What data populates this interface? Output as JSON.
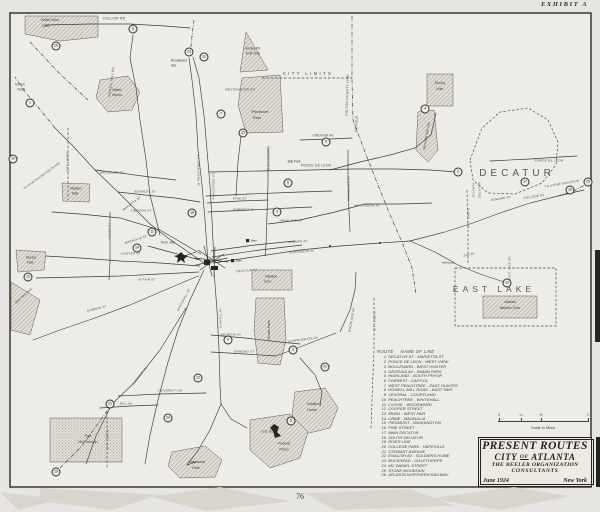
{
  "page": {
    "exhibit_label": "EXHIBIT A",
    "page_number": "76"
  },
  "title_box": {
    "line1": "PRESENT ROUTES",
    "city_pre": "CITY",
    "city_of": "OF",
    "city_post": "ATLANTA",
    "org_line1": "THE BEELER ORGANIZATION",
    "org_line2": "CONSULTANTS",
    "date": "June 1924",
    "place": "New York"
  },
  "scale_bar": {
    "ticks": [
      "0",
      "¼",
      "½",
      "1"
    ],
    "caption": "Scale in Miles"
  },
  "route_list": {
    "col_route": "ROUTE",
    "col_name": "NAME OF LINE",
    "routes": [
      {
        "num": "1",
        "name": "DECATUR ST - MARIETTA ST"
      },
      {
        "num": "2",
        "name": "PONCE DE LEON - WEST VIEW"
      },
      {
        "num": "3",
        "name": "BOULEVARD - WEST HUNTER"
      },
      {
        "num": "4",
        "name": "GEORGIA AV - INMAN PARK"
      },
      {
        "num": "5",
        "name": "HIGHLAND - SOUTH PRYOR"
      },
      {
        "num": "6",
        "name": "FORREST - CAPITOL"
      },
      {
        "num": "7",
        "name": "WEST PEACHTREE - EAST HUNTER"
      },
      {
        "num": "8",
        "name": "HOWELL MILL ROAD - EAST FAIR"
      },
      {
        "num": "9",
        "name": "CENTRAL - COURTLAND"
      },
      {
        "num": "10",
        "name": "PEACHTREE - WHITEHALL"
      },
      {
        "num": "11",
        "name": "LUCKIE - WOODWARD"
      },
      {
        "num": "12",
        "name": "COOPER STREET"
      },
      {
        "num": "13",
        "name": "IRWIN - WEST FAIR"
      },
      {
        "num": "14",
        "name": "ORME - MAGNOLIA"
      },
      {
        "num": "15",
        "name": "PIEDMONT - WASHINGTON"
      },
      {
        "num": "16",
        "name": "PINE STREET"
      },
      {
        "num": "17",
        "name": "MAIN DECATUR"
      },
      {
        "num": "18",
        "name": "SOUTH DECATUR"
      },
      {
        "num": "19",
        "name": "RIVER LINE"
      },
      {
        "num": "20",
        "name": "COLLEGE PARK - HAPEVILLE"
      },
      {
        "num": "21",
        "name": "STEWART AVENUE"
      },
      {
        "num": "22",
        "name": "ENGLISH AV - SOLDIERS HOME"
      },
      {
        "num": "23",
        "name": "BUCKHEAD - OGLETHORPE"
      },
      {
        "num": "24",
        "name": "MC DANIEL STREET"
      },
      {
        "num": "25",
        "name": "STONE MOUNTAIN"
      },
      {
        "num": "26",
        "name": "ATLANTA NORTHERN RAILWAY"
      }
    ]
  },
  "map": {
    "ink_color": "#3b3a33",
    "paper_color": "#edece6",
    "labels": [
      {
        "t": "North View",
        "x": 50,
        "y": 21,
        "r": 0,
        "s": 3.6,
        "cls": "p"
      },
      {
        "t": "Cem.",
        "x": 46,
        "y": 27,
        "r": 0,
        "s": 3.6,
        "cls": "p"
      },
      {
        "t": "COLLIER RD",
        "x": 114,
        "y": 19,
        "r": 0,
        "s": 3.4,
        "cls": "s"
      },
      {
        "t": "HOWELL MILL RD",
        "x": 112,
        "y": 82,
        "r": -82,
        "s": 3.2,
        "cls": "s"
      },
      {
        "t": "Inman",
        "x": 20,
        "y": 85,
        "r": 0,
        "s": 3.4,
        "cls": "p"
      },
      {
        "t": "Yards",
        "x": 21,
        "y": 90,
        "r": 0,
        "s": 3.4,
        "cls": "p"
      },
      {
        "t": "Water",
        "x": 117,
        "y": 91,
        "r": 0,
        "s": 3.6,
        "cls": "p"
      },
      {
        "t": "Works",
        "x": 117,
        "y": 96,
        "r": 0,
        "s": 3.6,
        "cls": "p"
      },
      {
        "t": "Brookwood",
        "x": 179,
        "y": 61,
        "r": 0,
        "s": 3.2,
        "cls": "p"
      },
      {
        "t": "Sta.",
        "x": 174,
        "y": 66,
        "r": 0,
        "s": 3.2,
        "cls": "p"
      },
      {
        "t": "Ansley Pk.",
        "x": 253,
        "y": 49,
        "r": 0,
        "s": 3.4,
        "cls": "p"
      },
      {
        "t": "Golf Club",
        "x": 253,
        "y": 54,
        "r": 0,
        "s": 3.4,
        "cls": "p"
      },
      {
        "t": "CITY LIMITS",
        "x": 308,
        "y": 74,
        "r": 0,
        "s": 4.2,
        "cls": "s sls"
      },
      {
        "t": "FULTON COUNTY LINE",
        "x": 348,
        "y": 95,
        "r": -88,
        "s": 3.4,
        "cls": "s"
      },
      {
        "t": "DE KALB",
        "x": 357,
        "y": 124,
        "r": -88,
        "s": 3.4,
        "cls": "s"
      },
      {
        "t": "Emory",
        "x": 440,
        "y": 84,
        "r": 0,
        "s": 3.6,
        "cls": "p"
      },
      {
        "t": "Univ.",
        "x": 440,
        "y": 90,
        "r": 0,
        "s": 3.6,
        "cls": "p"
      },
      {
        "t": "Druid Hills Golf Club",
        "x": 427,
        "y": 136,
        "r": -80,
        "s": 3.1,
        "cls": "p"
      },
      {
        "t": "DECATUR",
        "x": 517,
        "y": 174,
        "r": 0,
        "s": 10,
        "cls": "big"
      },
      {
        "t": "PONCE DE LEON",
        "x": 549,
        "y": 161,
        "r": 0,
        "s": 3.1,
        "cls": "s"
      },
      {
        "t": "TO STONE MOUNTAIN",
        "x": 562,
        "y": 184,
        "r": -10,
        "s": 2.9,
        "cls": "s"
      },
      {
        "t": "ATLANTA",
        "x": 474,
        "y": 190,
        "r": -90,
        "s": 3,
        "cls": "s"
      },
      {
        "t": "DECATUR",
        "x": 480,
        "y": 190,
        "r": -90,
        "s": 3,
        "cls": "s"
      },
      {
        "t": "HOWARD ST",
        "x": 501,
        "y": 199,
        "r": -9,
        "s": 3,
        "cls": "s"
      },
      {
        "t": "COLLEGE AV",
        "x": 534,
        "y": 197,
        "r": -9,
        "s": 3,
        "cls": "s"
      },
      {
        "t": "PONCE DE LEON",
        "x": 316,
        "y": 166,
        "r": 0,
        "s": 3.3,
        "cls": "s"
      },
      {
        "t": "Ball Park",
        "x": 294,
        "y": 162,
        "r": 0,
        "s": 3.2,
        "cls": "p"
      },
      {
        "t": "VIRGINIA AV",
        "x": 323,
        "y": 136,
        "r": 0,
        "s": 3.2,
        "cls": "s"
      },
      {
        "t": "WESTMINSTER DR",
        "x": 240,
        "y": 90,
        "r": 0,
        "s": 2.9,
        "cls": "s"
      },
      {
        "t": "Piedmont",
        "x": 260,
        "y": 112,
        "r": 0,
        "s": 4,
        "cls": "p"
      },
      {
        "t": "Park",
        "x": 257,
        "y": 118,
        "r": 0,
        "s": 4,
        "cls": "p"
      },
      {
        "t": "W PEACHTREE ST",
        "x": 199,
        "y": 170,
        "r": -90,
        "s": 3.1,
        "cls": "s"
      },
      {
        "t": "PEACHTREE ST",
        "x": 214,
        "y": 186,
        "r": -90,
        "s": 3.1,
        "cls": "s"
      },
      {
        "t": "N BOULEVARD",
        "x": 269,
        "y": 158,
        "r": -90,
        "s": 3.1,
        "cls": "s"
      },
      {
        "t": "MORELAND AV",
        "x": 349,
        "y": 188,
        "r": -90,
        "s": 3.1,
        "cls": "s"
      },
      {
        "t": "PINE ST",
        "x": 240,
        "y": 199,
        "r": 0,
        "s": 3,
        "cls": "s"
      },
      {
        "t": "FORREST AV",
        "x": 244,
        "y": 210,
        "r": 0,
        "s": 3,
        "cls": "s"
      },
      {
        "t": "HIGHLAND AV",
        "x": 291,
        "y": 221,
        "r": 0,
        "s": 3,
        "cls": "s"
      },
      {
        "t": "MC LENDON AV",
        "x": 367,
        "y": 206,
        "r": 0,
        "s": 3,
        "cls": "s"
      },
      {
        "t": "BELLWOOD AV",
        "x": 112,
        "y": 173,
        "r": 0,
        "s": 3,
        "cls": "s"
      },
      {
        "t": "KENNEDY ST",
        "x": 145,
        "y": 192,
        "r": 0,
        "s": 3,
        "cls": "s"
      },
      {
        "t": "SIMPSON ST",
        "x": 141,
        "y": 211,
        "r": 0,
        "s": 3,
        "cls": "s"
      },
      {
        "t": "HUNTER ST",
        "x": 131,
        "y": 254,
        "r": 0,
        "s": 3,
        "cls": "s"
      },
      {
        "t": "W FAIR ST",
        "x": 147,
        "y": 280,
        "r": 0,
        "s": 3,
        "cls": "s"
      },
      {
        "t": "MAGNOLIA ST",
        "x": 136,
        "y": 240,
        "r": -18,
        "s": 3,
        "cls": "s"
      },
      {
        "t": "ASHBY ST",
        "x": 110,
        "y": 231,
        "r": -90,
        "s": 3,
        "cls": "s"
      },
      {
        "t": "GORDON ST",
        "x": 97,
        "y": 309,
        "r": -14,
        "s": 3,
        "cls": "s"
      },
      {
        "t": "Maddox",
        "x": 76,
        "y": 189,
        "r": 0,
        "s": 3.2,
        "cls": "p"
      },
      {
        "t": "Park",
        "x": 75,
        "y": 194,
        "r": 0,
        "s": 3.2,
        "cls": "p"
      },
      {
        "t": "Mozley",
        "x": 31,
        "y": 258,
        "r": 0,
        "s": 3.2,
        "cls": "p"
      },
      {
        "t": "Park",
        "x": 30,
        "y": 263,
        "r": 0,
        "s": 3.2,
        "cls": "p"
      },
      {
        "t": "West View Cem.",
        "x": 24,
        "y": 296,
        "r": -42,
        "s": 3.1,
        "cls": "p"
      },
      {
        "t": "CITY LIMITS",
        "x": 68,
        "y": 162,
        "r": -90,
        "s": 3.1,
        "cls": "s"
      },
      {
        "t": "Term. Sta.",
        "x": 168,
        "y": 243,
        "r": 0,
        "s": 3.3,
        "cls": "p"
      },
      {
        "t": "Barn",
        "x": 254,
        "y": 241,
        "r": 0,
        "s": 3,
        "cls": "p"
      },
      {
        "t": "Barn",
        "x": 239,
        "y": 261,
        "r": 0,
        "s": 3,
        "cls": "p"
      },
      {
        "t": "DECATUR ST",
        "x": 247,
        "y": 271,
        "r": -4,
        "s": 3,
        "cls": "s"
      },
      {
        "t": "EDGEWOOD AV",
        "x": 302,
        "y": 252,
        "r": -4,
        "s": 3,
        "cls": "s"
      },
      {
        "t": "AUBURN AV",
        "x": 298,
        "y": 242,
        "r": -4,
        "s": 3,
        "cls": "s"
      },
      {
        "t": "Oakland",
        "x": 271,
        "y": 277,
        "r": 0,
        "s": 3.3,
        "cls": "p"
      },
      {
        "t": "Cem.",
        "x": 268,
        "y": 282,
        "r": 0,
        "s": 3.3,
        "cls": "p"
      },
      {
        "t": "GEORGIA AV",
        "x": 231,
        "y": 335,
        "r": 0,
        "s": 3,
        "cls": "s"
      },
      {
        "t": "ORMOND ST",
        "x": 244,
        "y": 352,
        "r": 0,
        "s": 3,
        "cls": "s"
      },
      {
        "t": "CONFEDERATE AV",
        "x": 303,
        "y": 340,
        "r": -8,
        "s": 3,
        "cls": "s"
      },
      {
        "t": "WOODLAND AV",
        "x": 352,
        "y": 320,
        "r": -80,
        "s": 3,
        "cls": "s"
      },
      {
        "t": "Grant Park",
        "x": 269,
        "y": 330,
        "r": -90,
        "s": 4,
        "cls": "p"
      },
      {
        "t": "Soldiers",
        "x": 313,
        "y": 405,
        "r": 0,
        "s": 3.6,
        "cls": "p"
      },
      {
        "t": "Home",
        "x": 312,
        "y": 411,
        "r": 0,
        "s": 3.6,
        "cls": "p"
      },
      {
        "t": "CITY LIMITS",
        "x": 375,
        "y": 321,
        "r": -90,
        "s": 3,
        "cls": "s"
      },
      {
        "t": "CITY LIMITS",
        "x": 469,
        "y": 218,
        "r": -90,
        "s": 3,
        "cls": "s"
      },
      {
        "t": "EAST LAKE",
        "x": 494,
        "y": 289,
        "r": 0,
        "s": 8.5,
        "cls": "big"
      },
      {
        "t": "Atlanta",
        "x": 510,
        "y": 303,
        "r": 0,
        "s": 3.6,
        "cls": "p"
      },
      {
        "t": "Athletic Club",
        "x": 510,
        "y": 309,
        "r": 0,
        "s": 3.6,
        "cls": "p"
      },
      {
        "t": "Kirkwood",
        "x": 448,
        "y": 263,
        "r": 0,
        "s": 3,
        "cls": "p"
      },
      {
        "t": "2ND AV",
        "x": 469,
        "y": 255,
        "r": -14,
        "s": 2.9,
        "cls": "s"
      },
      {
        "t": "EAST LAKE DR",
        "x": 510,
        "y": 268,
        "r": -90,
        "s": 2.9,
        "cls": "s"
      },
      {
        "t": "Fort",
        "x": 88,
        "y": 437,
        "r": 0,
        "s": 3.8,
        "cls": "p"
      },
      {
        "t": "McPherson",
        "x": 88,
        "y": 443,
        "r": 0,
        "s": 3.8,
        "cls": "p"
      },
      {
        "t": "CITY LIMITS",
        "x": 108,
        "y": 440,
        "r": -90,
        "s": 3,
        "cls": "s"
      },
      {
        "t": "UNIVERSITY AV",
        "x": 170,
        "y": 391,
        "r": 0,
        "s": 2.9,
        "cls": "s"
      },
      {
        "t": "DILL AV",
        "x": 126,
        "y": 404,
        "r": 0,
        "s": 2.9,
        "cls": "s"
      },
      {
        "t": "Lakewood",
        "x": 197,
        "y": 463,
        "r": 0,
        "s": 3.6,
        "cls": "p"
      },
      {
        "t": "Park",
        "x": 196,
        "y": 469,
        "r": 0,
        "s": 3.6,
        "cls": "p"
      },
      {
        "t": "U.S. Gov",
        "x": 268,
        "y": 432,
        "r": 0,
        "s": 3.4,
        "cls": "p"
      },
      {
        "t": "Federal",
        "x": 284,
        "y": 444,
        "r": 0,
        "s": 3.4,
        "cls": "p"
      },
      {
        "t": "Prison",
        "x": 284,
        "y": 450,
        "r": 0,
        "s": 3.4,
        "cls": "p"
      },
      {
        "t": "TO CHATTAHOOCHEE RIVER",
        "x": 42,
        "y": 176,
        "r": -36,
        "s": 2.8,
        "cls": "s"
      },
      {
        "t": "MARIETTA ST",
        "x": 132,
        "y": 204,
        "r": -36,
        "s": 3,
        "cls": "s"
      },
      {
        "t": "WHITEHALL ST",
        "x": 184,
        "y": 300,
        "r": -62,
        "s": 3,
        "cls": "s"
      },
      {
        "t": "STEWART AV",
        "x": 140,
        "y": 376,
        "r": -52,
        "s": 3,
        "cls": "s"
      },
      {
        "t": "CAPITOL AV",
        "x": 221,
        "y": 318,
        "r": -90,
        "s": 3,
        "cls": "s"
      }
    ],
    "circles": [
      {
        "n": "19",
        "x": 13,
        "y": 159
      },
      {
        "n": "26",
        "x": 56,
        "y": 46
      },
      {
        "n": "8",
        "x": 133,
        "y": 29
      },
      {
        "n": "1",
        "x": 30,
        "y": 103
      },
      {
        "n": "23",
        "x": 189,
        "y": 52
      },
      {
        "n": "10",
        "x": 204,
        "y": 57
      },
      {
        "n": "7",
        "x": 221,
        "y": 114
      },
      {
        "n": "15",
        "x": 243,
        "y": 133
      },
      {
        "n": "5",
        "x": 326,
        "y": 142
      },
      {
        "n": "6",
        "x": 288,
        "y": 183
      },
      {
        "n": "3",
        "x": 277,
        "y": 212
      },
      {
        "n": "16",
        "x": 192,
        "y": 213
      },
      {
        "n": "11",
        "x": 152,
        "y": 232
      },
      {
        "n": "14",
        "x": 137,
        "y": 248
      },
      {
        "n": "13",
        "x": 28,
        "y": 277
      },
      {
        "n": "4",
        "x": 425,
        "y": 109
      },
      {
        "n": "2",
        "x": 458,
        "y": 172
      },
      {
        "n": "17",
        "x": 525,
        "y": 182
      },
      {
        "n": "18",
        "x": 570,
        "y": 190
      },
      {
        "n": "25",
        "x": 588,
        "y": 182
      },
      {
        "n": "13",
        "x": 507,
        "y": 283
      },
      {
        "n": "9",
        "x": 293,
        "y": 350
      },
      {
        "n": "22",
        "x": 325,
        "y": 367
      },
      {
        "n": "4",
        "x": 228,
        "y": 340
      },
      {
        "n": "12",
        "x": 198,
        "y": 378
      },
      {
        "n": "5",
        "x": 291,
        "y": 421
      },
      {
        "n": "24",
        "x": 168,
        "y": 418
      },
      {
        "n": "21",
        "x": 110,
        "y": 404
      },
      {
        "n": "20",
        "x": 56,
        "y": 472
      }
    ]
  }
}
